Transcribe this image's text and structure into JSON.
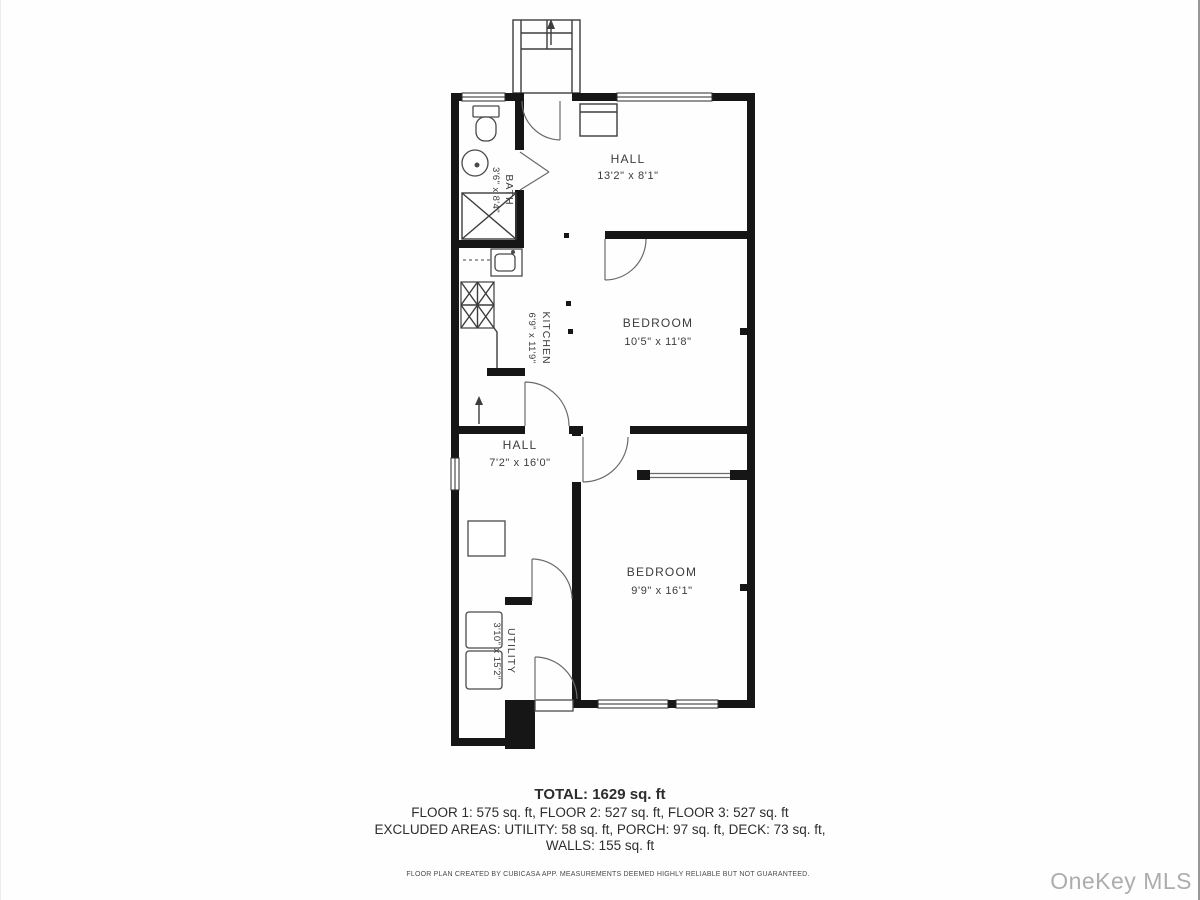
{
  "plan": {
    "rooms": [
      {
        "name": "BATH",
        "dims": "3'6\" x 8'4\""
      },
      {
        "name": "HALL",
        "dims": "13'2\" x 8'1\""
      },
      {
        "name": "KITCHEN",
        "dims": "6'9\" x 11'9\""
      },
      {
        "name": "BEDROOM",
        "dims": "10'5\" x 11'8\""
      },
      {
        "name": "HALL",
        "dims": "7'2\" x 16'0\""
      },
      {
        "name": "BEDROOM",
        "dims": "9'9\" x 16'1\""
      },
      {
        "name": "UTILITY",
        "dims": "3'10\" x 15'2\""
      }
    ]
  },
  "summary": {
    "total": "TOTAL: 1629 sq. ft",
    "floors": "FLOOR 1: 575 sq. ft, FLOOR 2: 527 sq. ft, FLOOR 3: 527 sq. ft",
    "excluded": "EXCLUDED AREAS: UTILITY: 58 sq. ft, PORCH: 97 sq. ft, DECK: 73 sq. ft,",
    "walls": "WALLS: 155 sq. ft"
  },
  "footer": {
    "disclaimer": "FLOOR PLAN CREATED BY CUBICASA APP. MEASUREMENTS DEEMED HIGHLY RELIABLE BUT NOT GUARANTEED."
  },
  "watermark": "OneKey MLS",
  "colors": {
    "wall": "#161616",
    "label": "#3c3c3c",
    "watermark": "#adadad"
  }
}
